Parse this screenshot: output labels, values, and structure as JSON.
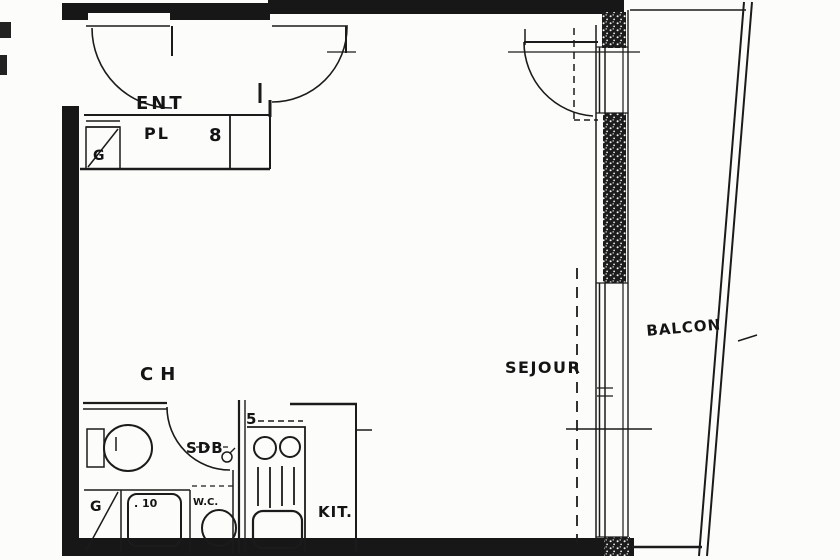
{
  "plan": {
    "labels": {
      "ent": "ENT",
      "pl": "PL",
      "mark_8": "8",
      "g_top": "G",
      "ch": "CH",
      "sdb": "SDB",
      "g_bottom": "G",
      "shower_mark": ". 10",
      "wc": "W.C.",
      "mark_5": "5",
      "kit": "KIT.",
      "sejour": "SEJOUR",
      "balcon": "BALCON"
    },
    "colors": {
      "line": "#1b1b1b",
      "wall_fill": "#171717",
      "background": "#fcfcfa"
    }
  }
}
